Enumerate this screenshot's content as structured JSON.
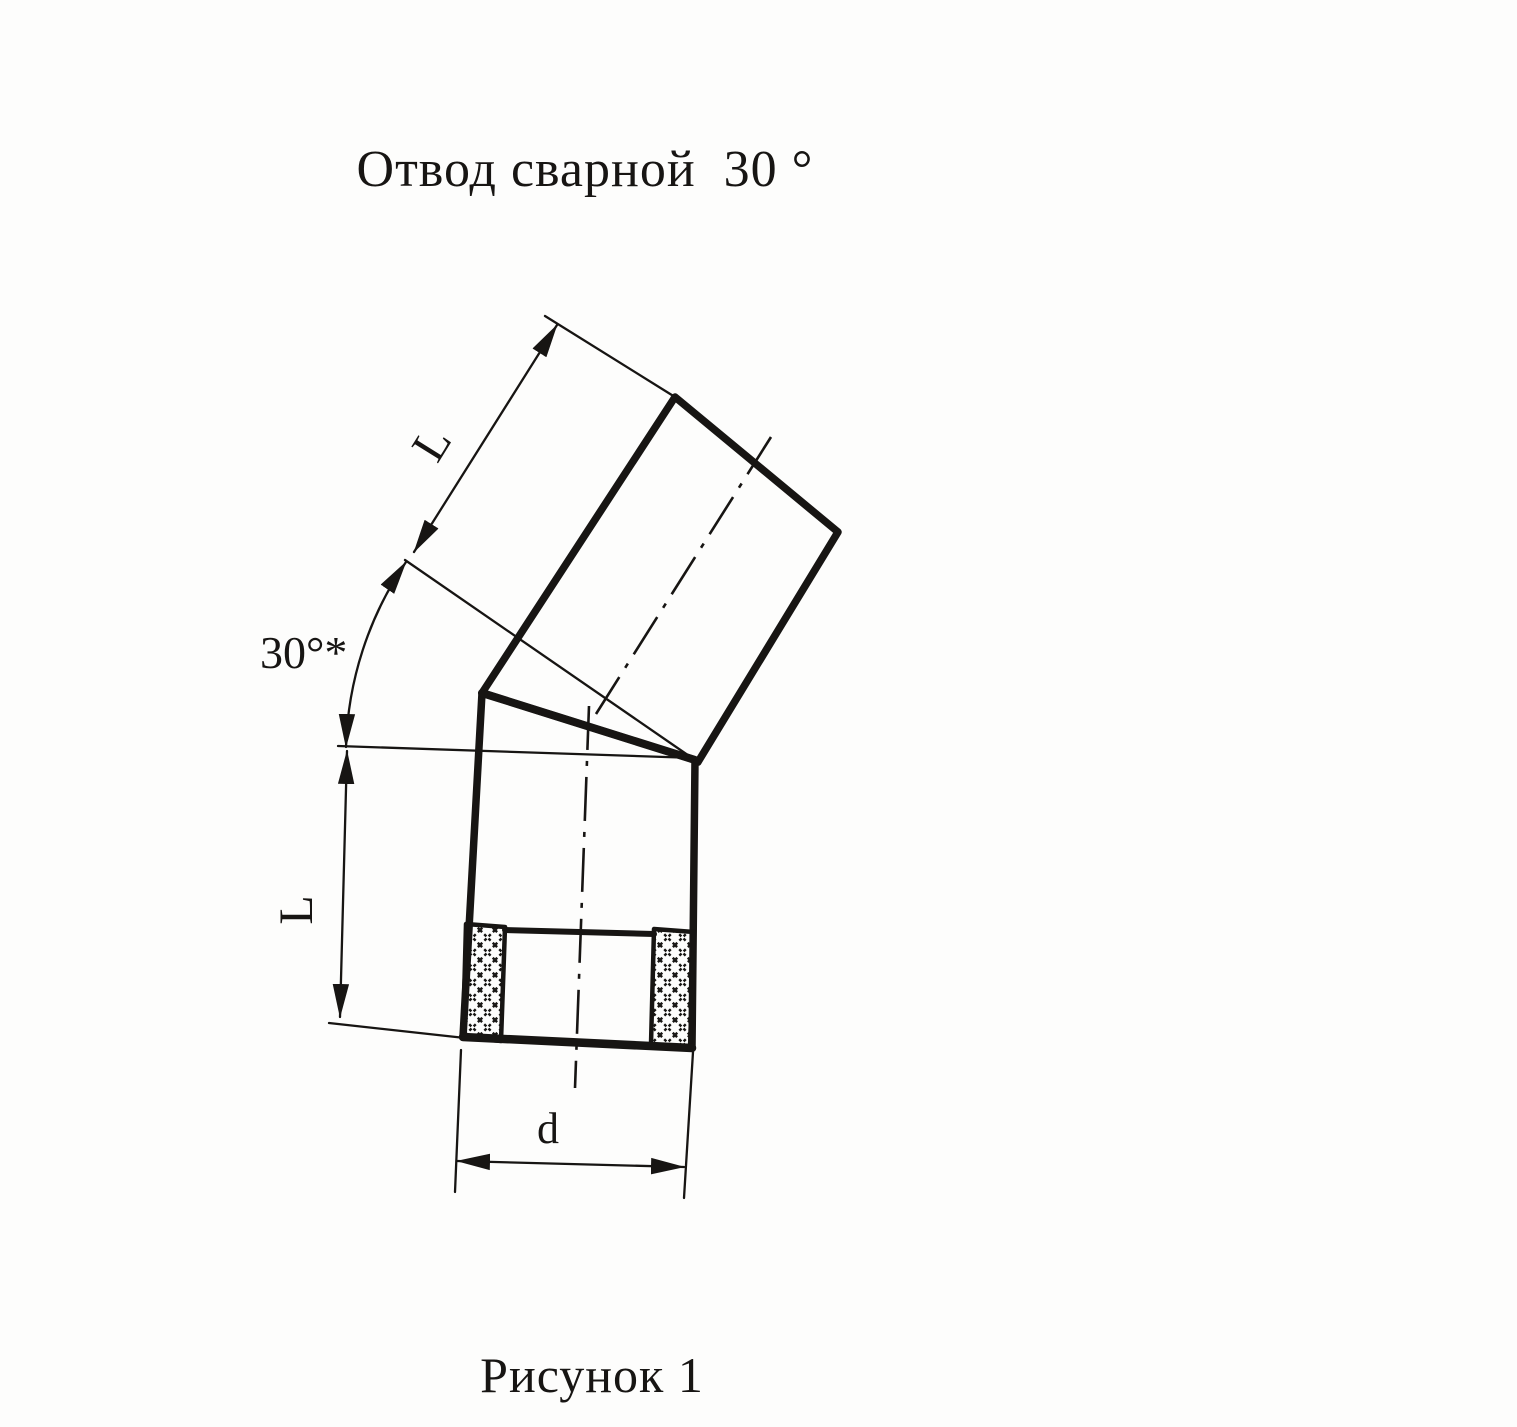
{
  "page": {
    "background_color": "#fdfdfc",
    "ink_color": "#171513"
  },
  "title": "Отвод сварной  30 °",
  "caption": "Рисунок 1",
  "dimensions": {
    "upper_segment_length_label": "L",
    "lower_segment_length_label": "L",
    "diameter_label": "d",
    "angle_label": "30°*"
  }
}
